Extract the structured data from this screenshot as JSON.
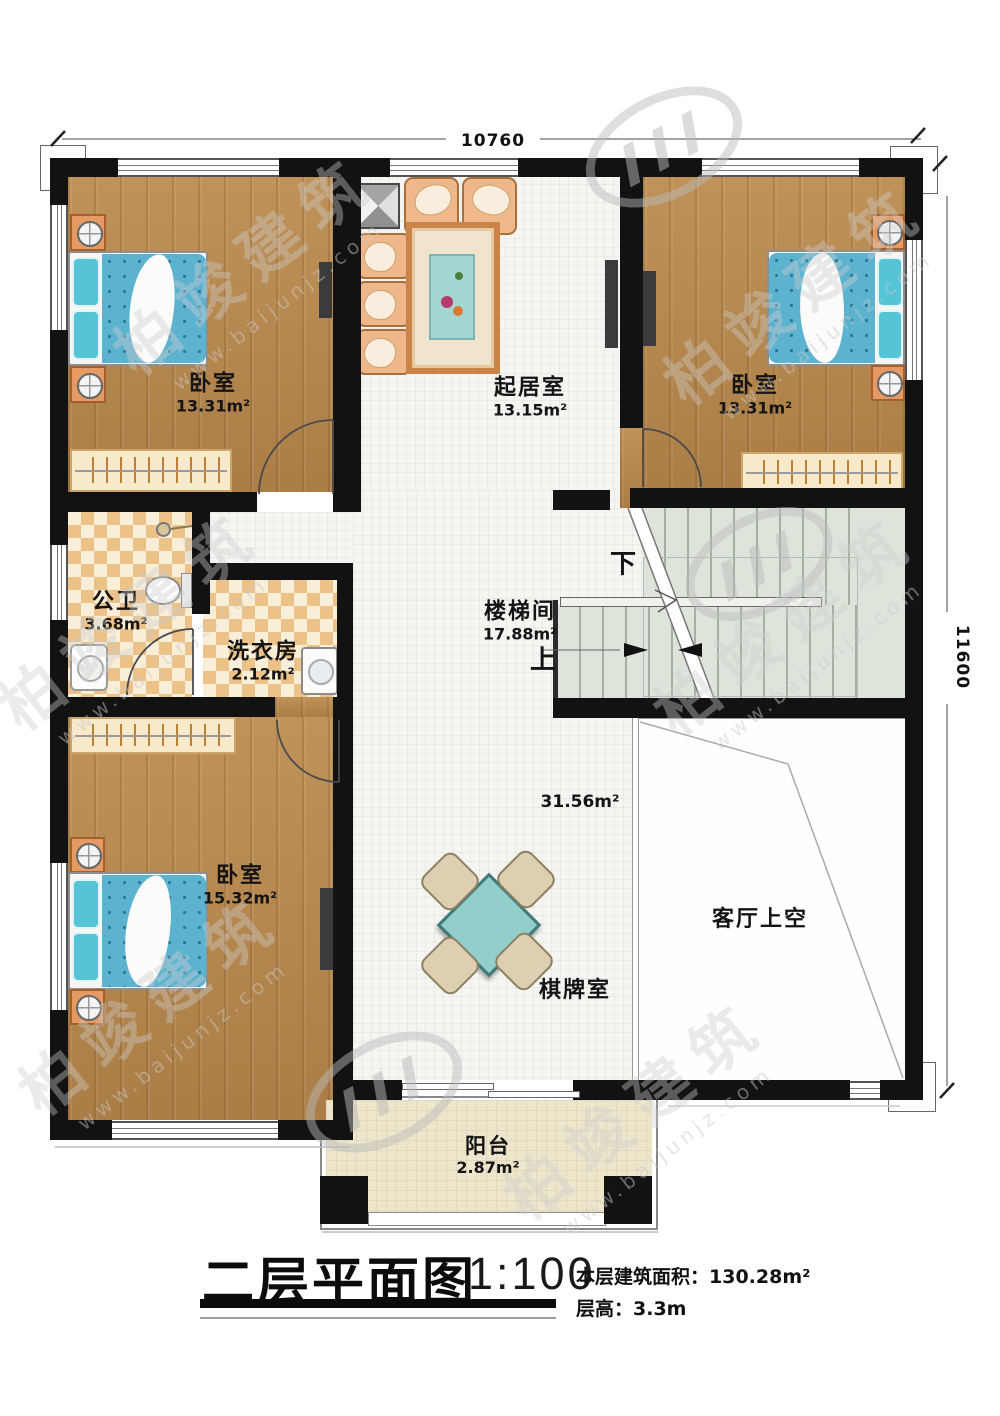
{
  "watermark": {
    "brand": "柏竣建筑",
    "url": "www.baijunjz.com"
  },
  "dimensions": {
    "top": "10760",
    "right": "11600"
  },
  "rooms": {
    "bedroom_top_left": {
      "name": "卧室",
      "area": "13.31m²"
    },
    "living": {
      "name": "起居室",
      "area": "13.15m²"
    },
    "bedroom_top_right": {
      "name": "卧室",
      "area": "13.31m²"
    },
    "bathroom": {
      "name": "公卫",
      "area": "3.68m²"
    },
    "laundry": {
      "name": "洗衣房",
      "area": "2.12m²"
    },
    "stairwell": {
      "name": "楼梯间",
      "area": "17.88m²",
      "down": "下",
      "up": "上"
    },
    "bedroom_bottom_left": {
      "name": "卧室",
      "area": "15.32m²"
    },
    "game_room": {
      "name": "棋牌室",
      "area": "31.56m²"
    },
    "living_void": {
      "name": "客厅上空"
    },
    "balcony": {
      "name": "阳台",
      "area": "2.87m²"
    }
  },
  "title_block": {
    "title": "二层平面图",
    "scale": "1:100",
    "floor_area_label": "本层建筑面积：",
    "floor_area_value": "130.28m²",
    "floor_height_label": "层高：",
    "floor_height_value": "3.3m"
  }
}
